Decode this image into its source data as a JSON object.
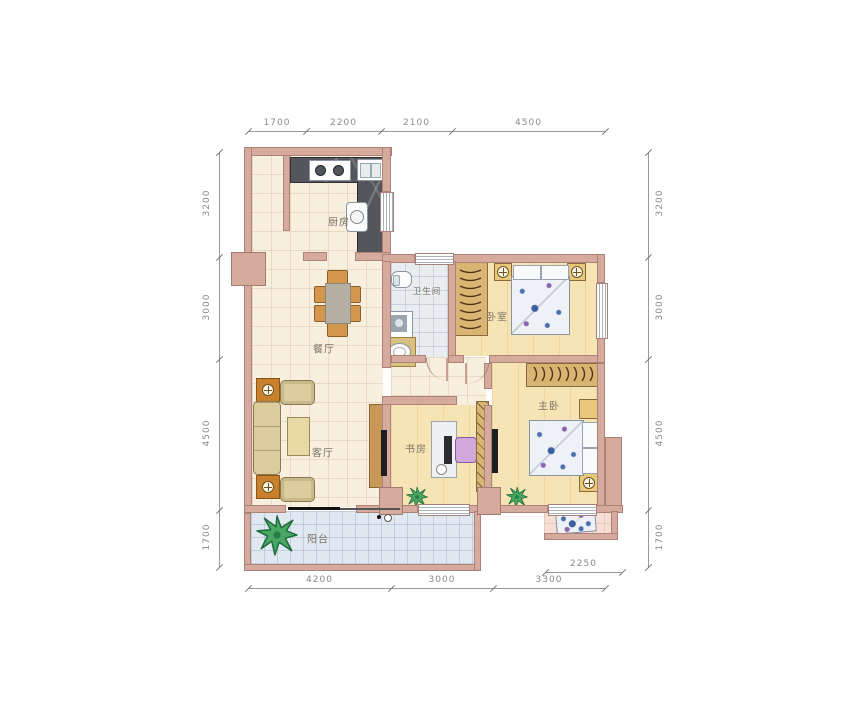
{
  "plan": {
    "rooms": {
      "kitchen": "厨房",
      "dining": "餐厅",
      "living": "客厅",
      "balcony": "阳台",
      "bathroom": "卫生间",
      "bedroom": "卧室",
      "study": "书房",
      "master_bedroom": "主卧"
    },
    "dims": {
      "top": [
        "1700",
        "2200",
        "2100",
        "4500"
      ],
      "left": [
        "3200",
        "3000",
        "4500",
        "1700"
      ],
      "right": [
        "3200",
        "3000",
        "4500",
        "1700"
      ],
      "bottom": [
        "4200",
        "3000",
        "3300"
      ],
      "sub_bottom": "2250"
    },
    "colors": {
      "wall": "#d6aa9c",
      "wall_edge": "#ab8378",
      "floor_tile": "#f9efdf",
      "floor_wood": "#f6e4b4",
      "floor_bath": "#e9edf0",
      "floor_balcony": "#e0e9f1",
      "floor_small_balcony": "#f6ded4",
      "counter_dark": "#55565b",
      "furniture_wood": "#d9b573",
      "dim_text": "#8a8a8a"
    }
  }
}
